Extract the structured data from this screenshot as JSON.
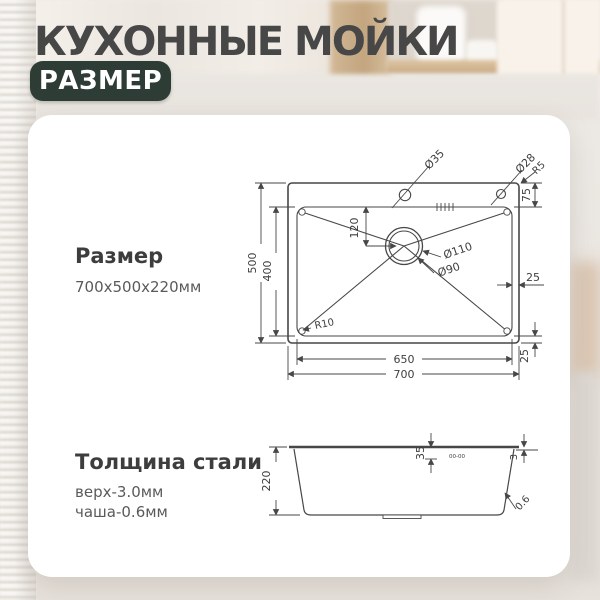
{
  "header": {
    "title": "КУХОННЫЕ МОЙКИ",
    "badge": "РАЗМЕР"
  },
  "panel": {
    "size_label": "Размер",
    "size_value": "700x500x220мм",
    "thickness_label": "Толщина стали",
    "thickness_top": "верх-3.0мм",
    "thickness_bowl": "чаша-0.6мм"
  },
  "drawing": {
    "top_view": {
      "overall_width": "700",
      "overall_depth": "500",
      "bowl_width": "650",
      "bowl_depth": "400",
      "rim_top": "75",
      "rim_right": "25",
      "rim_bottom": "25",
      "drain_offset": "120",
      "drain_outer_dia": "Ø110",
      "drain_inner_dia": "Ø90",
      "faucet_hole_dia": "Ø35",
      "accessory_hole_dia": "Ø28",
      "outer_corner_radius": "R5",
      "bowl_corner_radius": "R10"
    },
    "side_view": {
      "height": "220",
      "rim_height": "35",
      "top_thickness": "3",
      "wall_thickness": "0.6",
      "stamp_marks": "00-00"
    }
  },
  "colors": {
    "badge_bg": "#2d3c35",
    "title_text": "#474747",
    "line_color": "#474747",
    "card_bg": "#ffffff"
  }
}
